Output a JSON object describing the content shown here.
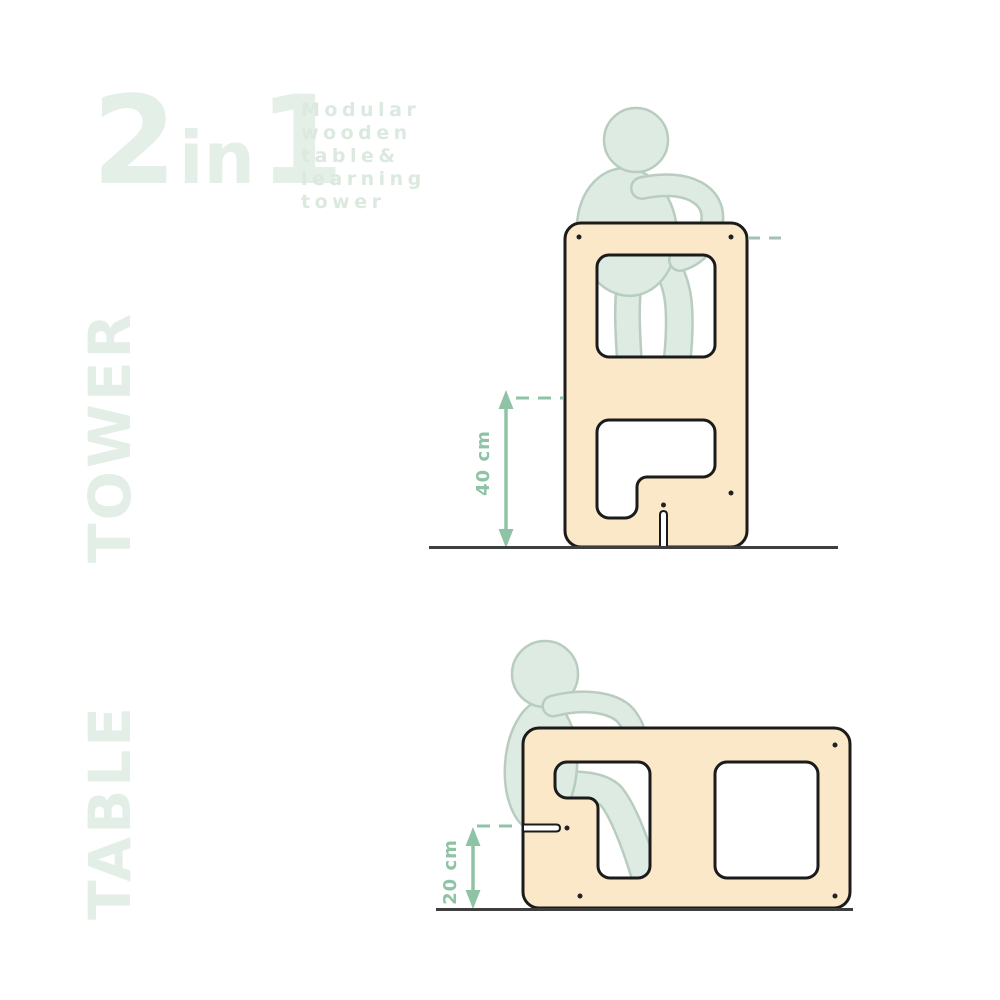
{
  "title": {
    "part_2": "2",
    "part_in": "in",
    "part_1": "1"
  },
  "subtitle": {
    "lines": [
      "Modular",
      "wooden",
      "table&",
      "learning",
      "tower"
    ]
  },
  "side_labels": {
    "tower": "TOWER",
    "table": "TABLE"
  },
  "tower_diagram": {
    "height_label": "40 cm"
  },
  "table_diagram": {
    "height_label": "20 cm"
  },
  "colors": {
    "title-green": "#E4EFE7",
    "subtitle-green": "#DCE9DF",
    "side-label-green": "#E2EEE6",
    "panel-fill": "#FBE8C9",
    "panel-outline": "#1B1B1B",
    "figure-fill": "#DEEBE2",
    "figure-outline": "#B8CDBF",
    "dimension-green": "#8FC3A6",
    "dash-green": "#A3C2B2",
    "ground-line": "#3E3E3E"
  }
}
